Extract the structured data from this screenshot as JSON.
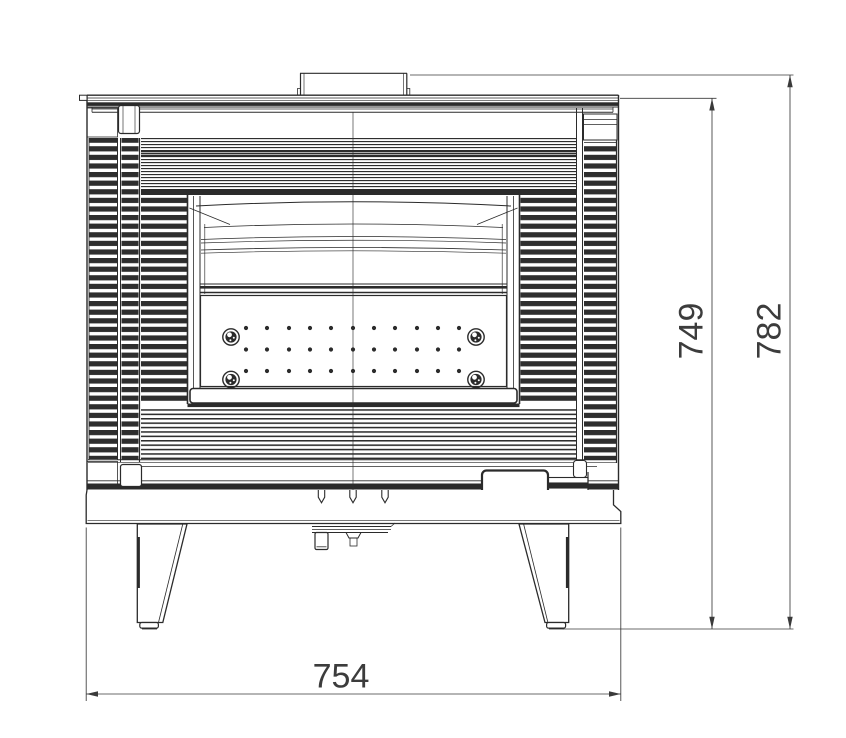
{
  "drawing": {
    "dimensions": {
      "width": "754",
      "body_height": "749",
      "overall_height": "782"
    },
    "colors": {
      "background": "#ffffff",
      "line": "#2b2b2b",
      "dimension_text": "#3c3c3c"
    }
  }
}
